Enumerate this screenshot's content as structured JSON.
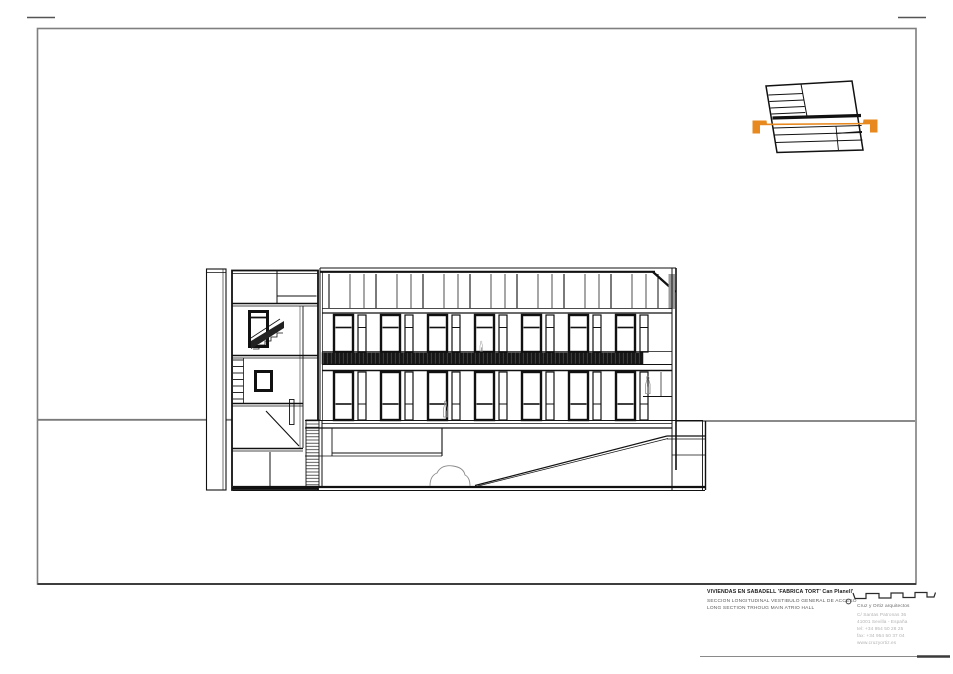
{
  "title_block": {
    "project_title": "VIVIENDAS EN SABADELL 'FABRICA TORT' Can Planell'",
    "drawing_title_es": "SECCION LONGITUDINAL VESTIBULO GENERAL DE ACCESO",
    "drawing_title_en": "LONG SECTION TRHOUG MAIN ATRIO HALL",
    "firm": {
      "name": "Cruz y Ortiz arquitectos",
      "street": "C/ Santas Patronas 36",
      "city": "41001 Sevilla - España",
      "tel": "tel: +34 954 50 28 25",
      "fax": "fax: +34 954 50 37 04",
      "web": "www.cruzyortiz.es"
    }
  },
  "colors": {
    "section_cut": "#E8891F",
    "border": "#7f7f7f",
    "line": "#111111",
    "ground": "#7a7a7a"
  },
  "drawing": {
    "type": "architectural-long-section"
  }
}
